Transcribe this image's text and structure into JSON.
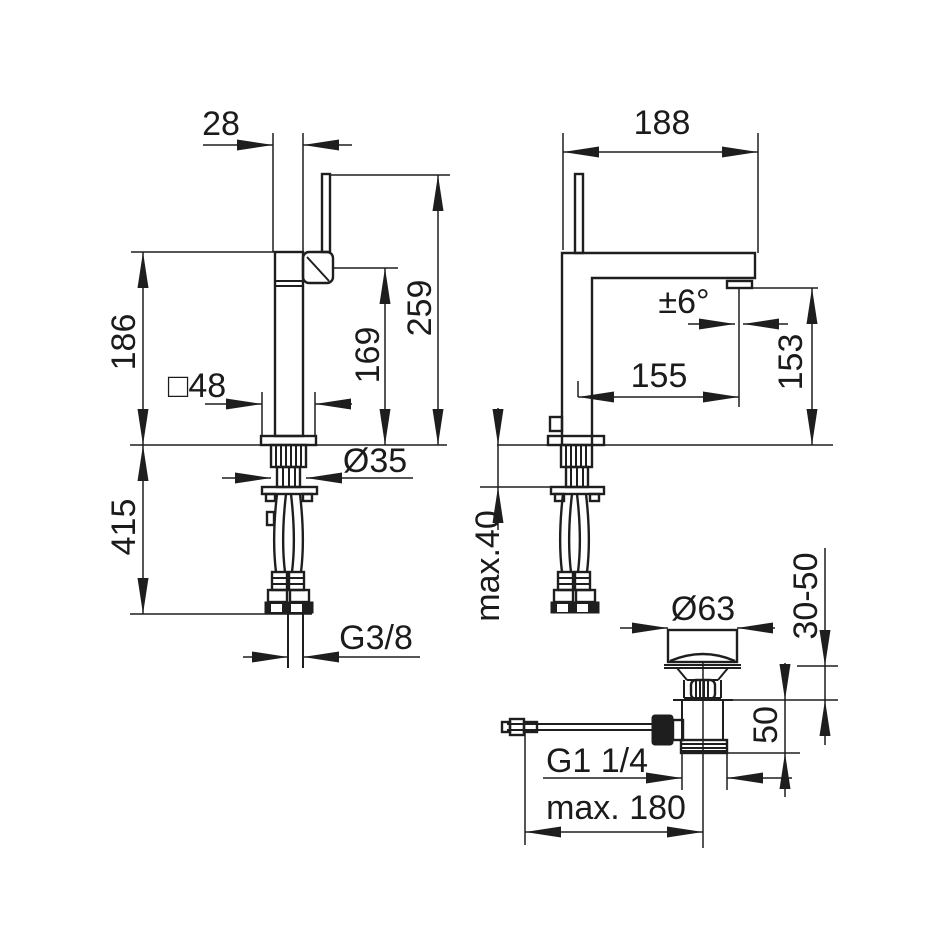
{
  "drawing": {
    "front_view": {
      "lever_body_width": "28",
      "height_to_body_top": "186",
      "outlet_height": "169",
      "total_height": "259",
      "base_square": "□48",
      "shank_diameter": "Ø35",
      "hose_length": "415",
      "supply_thread": "G3/8"
    },
    "side_view": {
      "depth": "188",
      "aerator_angle": "±6°",
      "spout_reach": "155",
      "outlet_height": "153",
      "max_deck_thickness": "max.40"
    },
    "drain_detail": {
      "flange_diameter": "Ø63",
      "clamping_range": "30-50",
      "thread_length": "50",
      "waste_thread": "G1 1/4",
      "max_rod_length": "max. 180"
    }
  }
}
